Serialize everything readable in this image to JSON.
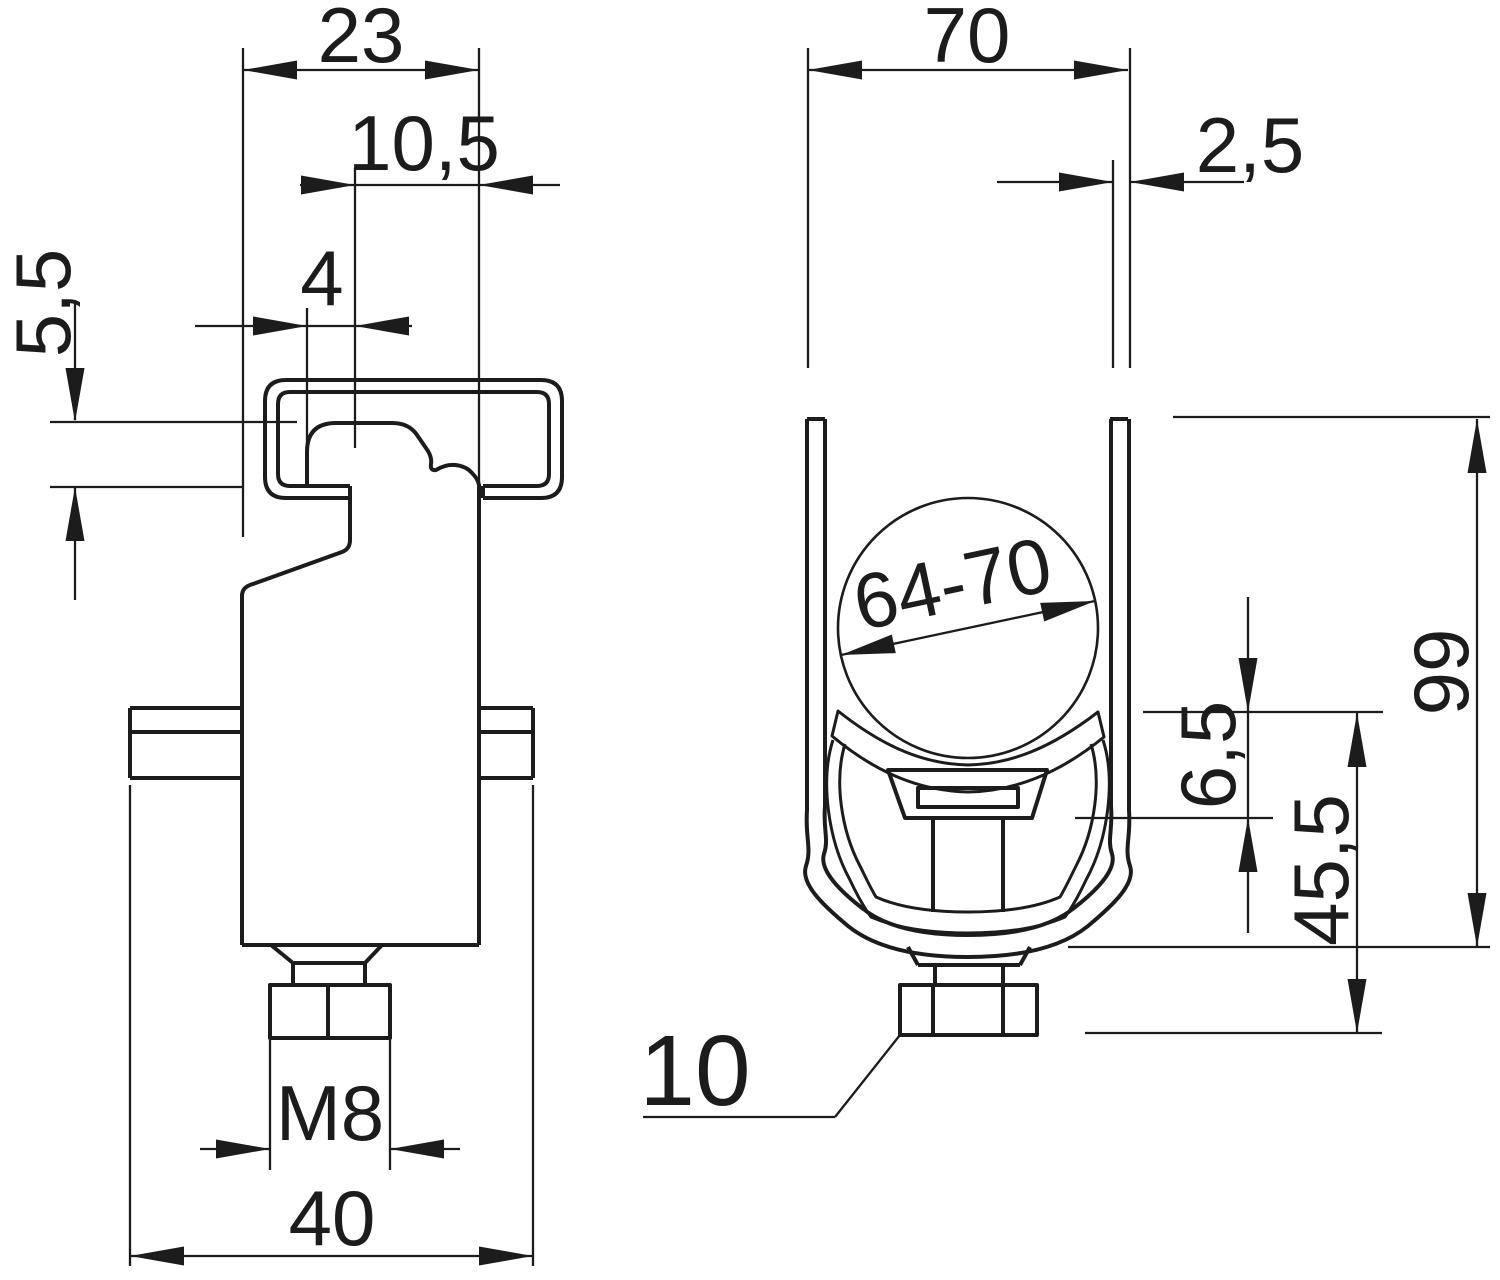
{
  "drawing": {
    "colors": {
      "line": "#1c1c1c",
      "background": "#ffffff"
    },
    "side_view": {
      "labels": {
        "head_width": "23",
        "head_offset": "10,5",
        "slot_width": "4",
        "head_height": "5,5",
        "thread": "M8",
        "base_width": "40"
      }
    },
    "front_view": {
      "labels": {
        "opening_width": "70",
        "wall_thickness": "2,5",
        "clamp_range": "64-70",
        "total_height": "99",
        "strap_offset": "6,5",
        "lower_height": "45,5",
        "nut_size": "10"
      }
    }
  }
}
